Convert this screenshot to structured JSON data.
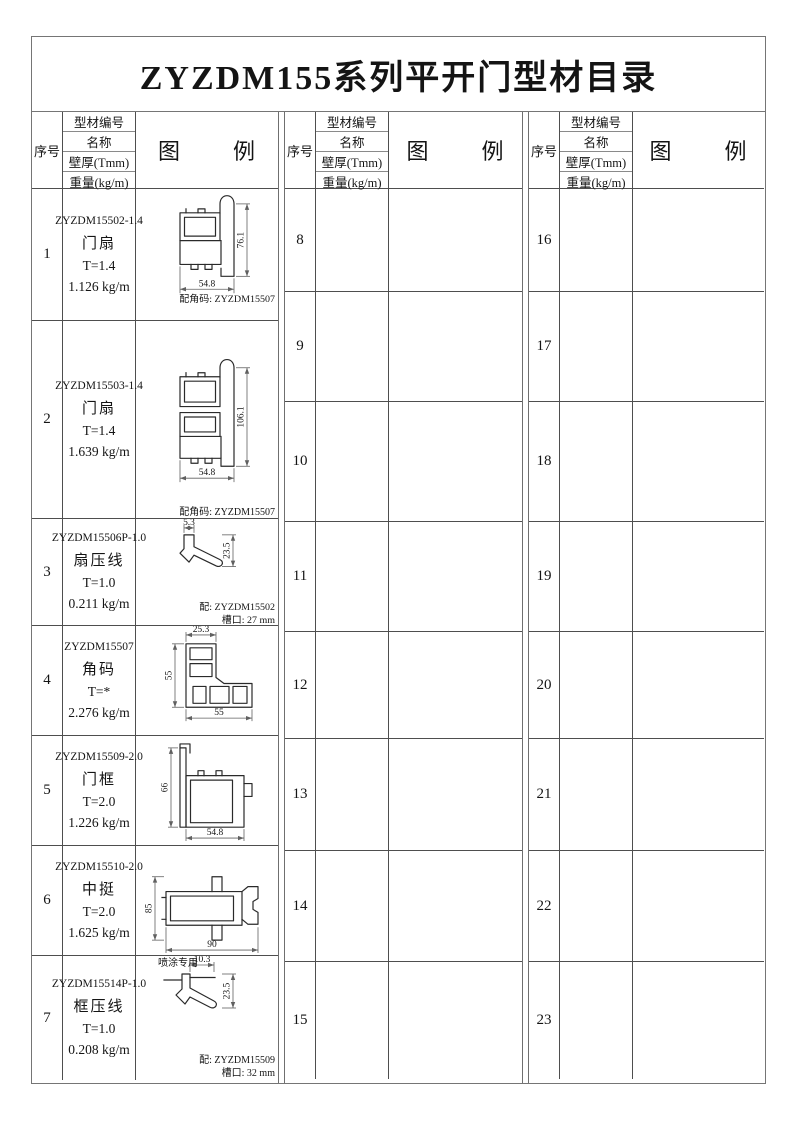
{
  "page": {
    "title": "ZYZDM155系列平开门型材目录"
  },
  "colors": {
    "frame_line": "#757575",
    "grid_line": "#4e4e4e",
    "ink": "#141414"
  },
  "table": {
    "header": {
      "seq": "序号",
      "info_rows": [
        "型材编号",
        "名称",
        "壁厚(Tmm)",
        "重量(kg/m)"
      ],
      "legend": "图        例"
    },
    "groups": [
      {
        "name": "group-1",
        "rows": [
          {
            "seq": "1",
            "code": "ZYZDM15502-1.4",
            "name": "门扇",
            "thickness": "T=1.4",
            "weight": "1.126 kg/m",
            "drawing": "door-sash-profile-small",
            "dims": {
              "height": "76.1",
              "width": "54.8"
            },
            "notes": [
              "配角码: ZYZDM15507"
            ]
          },
          {
            "seq": "2",
            "code": "ZYZDM15503-1.4",
            "name": "门扇",
            "thickness": "T=1.4",
            "weight": "1.639 kg/m",
            "drawing": "door-sash-profile-large",
            "dims": {
              "height": "106.1",
              "width": "54.8"
            },
            "notes": [
              "配角码: ZYZDM15507"
            ]
          },
          {
            "seq": "3",
            "code": "ZYZDM15506P-1.0",
            "name": "扇压线",
            "thickness": "T=1.0",
            "weight": "0.211 kg/m",
            "drawing": "sash-bead-profile",
            "dims": {
              "top": "5.3",
              "side": "23.5"
            },
            "notes": [
              "配: ZYZDM15502",
              "槽口: 27 mm"
            ]
          },
          {
            "seq": "4",
            "code": "ZYZDM15507",
            "name": "角码",
            "thickness": "T=*",
            "weight": "2.276 kg/m",
            "drawing": "corner-key-profile",
            "dims": {
              "top": "25.3",
              "left": "55",
              "bottom": "55"
            },
            "notes": []
          },
          {
            "seq": "5",
            "code": "ZYZDM15509-2.0",
            "name": "门框",
            "thickness": "T=2.0",
            "weight": "1.226 kg/m",
            "drawing": "door-frame-profile",
            "dims": {
              "left": "66",
              "width": "54.8"
            },
            "notes": []
          },
          {
            "seq": "6",
            "code": "ZYZDM15510-2.0",
            "name": "中挺",
            "thickness": "T=2.0",
            "weight": "1.625 kg/m",
            "drawing": "mullion-profile",
            "dims": {
              "left": "85",
              "bottom": "90"
            },
            "notes": [],
            "below_note": "喷涂专用"
          },
          {
            "seq": "7",
            "code": "ZYZDM15514P-1.0",
            "name": "框压线",
            "thickness": "T=1.0",
            "weight": "0.208 kg/m",
            "drawing": "frame-bead-profile",
            "dims": {
              "top": "10.3",
              "side": "23.5"
            },
            "notes": [
              "配: ZYZDM15509",
              "槽口: 32 mm"
            ]
          }
        ]
      },
      {
        "name": "group-2",
        "rows": [
          {
            "seq": "8"
          },
          {
            "seq": "9"
          },
          {
            "seq": "10"
          },
          {
            "seq": "11"
          },
          {
            "seq": "12"
          },
          {
            "seq": "13"
          },
          {
            "seq": "14"
          },
          {
            "seq": "15"
          }
        ]
      },
      {
        "name": "group-3",
        "rows": [
          {
            "seq": "16"
          },
          {
            "seq": "17"
          },
          {
            "seq": "18"
          },
          {
            "seq": "19"
          },
          {
            "seq": "20"
          },
          {
            "seq": "21"
          },
          {
            "seq": "22"
          },
          {
            "seq": "23"
          }
        ]
      }
    ]
  }
}
